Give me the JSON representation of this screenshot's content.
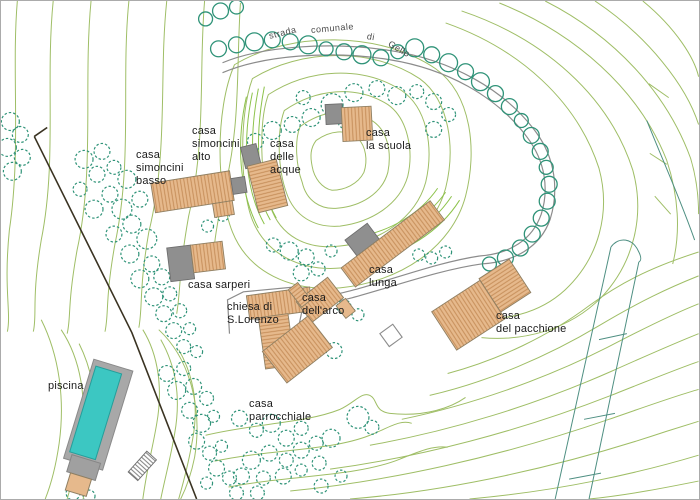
{
  "map": {
    "road_label": {
      "strada": "strada",
      "comunale": "comunale",
      "di": "di",
      "gello": "Gello"
    },
    "labels": {
      "piscina": "piscina",
      "casa_simoncini_basso": "casa\nsimoncini\nbasso",
      "casa_simoncini_alto": "casa\nsimoncini\nalto",
      "casa_delle_acque": "casa\ndelle\nacque",
      "casa_la_scuola": "casa\nla scuola",
      "casa_sarperi": "casa sarperi",
      "chiesa_s_lorenzo": "chiesa di\nS.Lorenzo",
      "casa_dell_arco": "casa\ndell'arco",
      "casa_lunga": "casa\nlunga",
      "casa_del_pacchione": "casa\ndel pacchione",
      "casa_parrocchiale": "casa\nparrocchiale"
    },
    "colors": {
      "contour_green": "#9fbe66",
      "contour_bright": "#8cc24a",
      "tree_teal": "#2f9378",
      "building_tan": "#e6b98c",
      "building_hatch": "#c28a55",
      "annex_gray": "#8f8f8f",
      "road_gray": "#8c8c8c",
      "boundary_dark": "#3a3322",
      "pool_water": "#3cc7c2",
      "parcel_teal": "#4e8f82"
    }
  }
}
